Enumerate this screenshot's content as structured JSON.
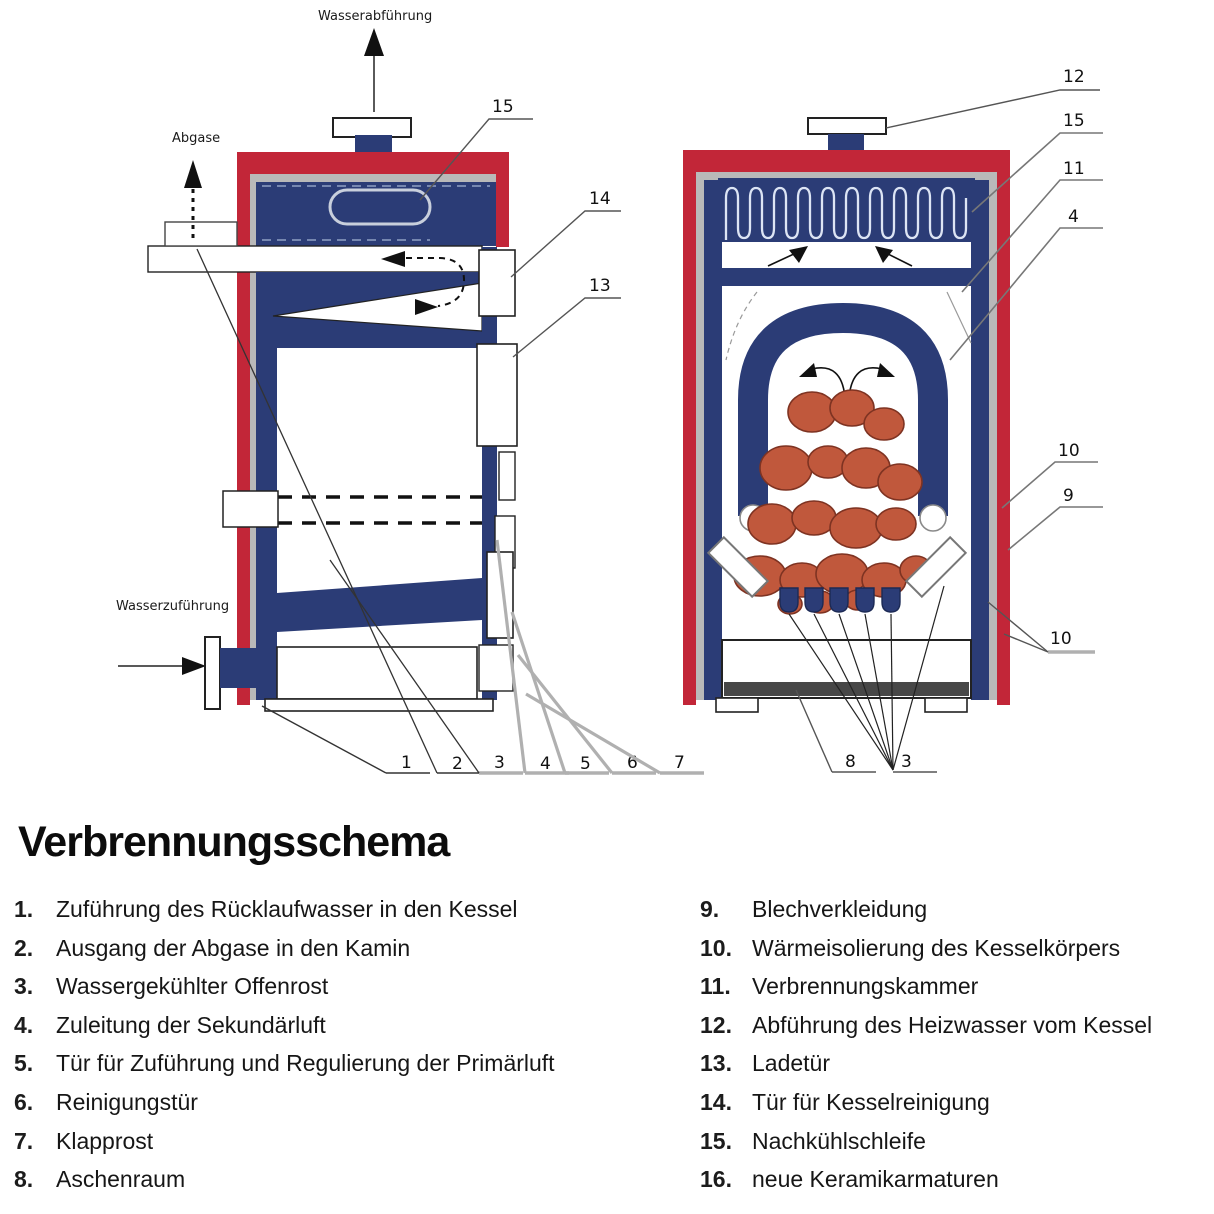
{
  "title": "Verbrennungsschema",
  "colors": {
    "red": "#c22638",
    "blue": "#2b3c76",
    "gray": "#b9b9b9",
    "fuel": "#c0583c",
    "ash_bar": "#474747"
  },
  "diagram": {
    "labels": {
      "water_out": "Wasserabführung",
      "flue_gas": "Abgase",
      "water_in": "Wasserzuführung"
    },
    "callouts": {
      "l15": "15",
      "l14": "14",
      "l13": "13",
      "bottom": [
        "1",
        "2",
        "3",
        "4",
        "5",
        "6",
        "7"
      ],
      "r12": "12",
      "r15": "15",
      "r11": "11",
      "r4": "4",
      "r10a": "10",
      "r9": "9",
      "r10b": "10",
      "r8": "8",
      "r3": "3"
    }
  },
  "legend": {
    "left": [
      {
        "n": "1.",
        "t": "Zuführung des Rücklaufwasser in den Kessel"
      },
      {
        "n": "2.",
        "t": "Ausgang der Abgase in den Kamin"
      },
      {
        "n": "3.",
        "t": "Wassergekühlter Offenrost"
      },
      {
        "n": "4.",
        "t": "Zuleitung der Sekundärluft"
      },
      {
        "n": "5.",
        "t": "Tür für Zuführung und Regulierung der Primärluft"
      },
      {
        "n": "6.",
        "t": "Reinigungstür"
      },
      {
        "n": "7.",
        "t": "Klapprost"
      },
      {
        "n": "8.",
        "t": "Aschenraum"
      }
    ],
    "right": [
      {
        "n": "9.",
        "t": "Blechverkleidung"
      },
      {
        "n": "10.",
        "t": "Wärmeisolierung des Kesselkörpers"
      },
      {
        "n": "11.",
        "t": "Verbrennungskammer"
      },
      {
        "n": "12.",
        "t": "Abführung des Heizwasser vom Kessel"
      },
      {
        "n": "13.",
        "t": "Ladetür"
      },
      {
        "n": "14.",
        "t": "Tür für Kesselreinigung"
      },
      {
        "n": "15.",
        "t": "Nachkühlschleife"
      },
      {
        "n": "16.",
        "t": "neue Keramikarmaturen"
      }
    ]
  }
}
